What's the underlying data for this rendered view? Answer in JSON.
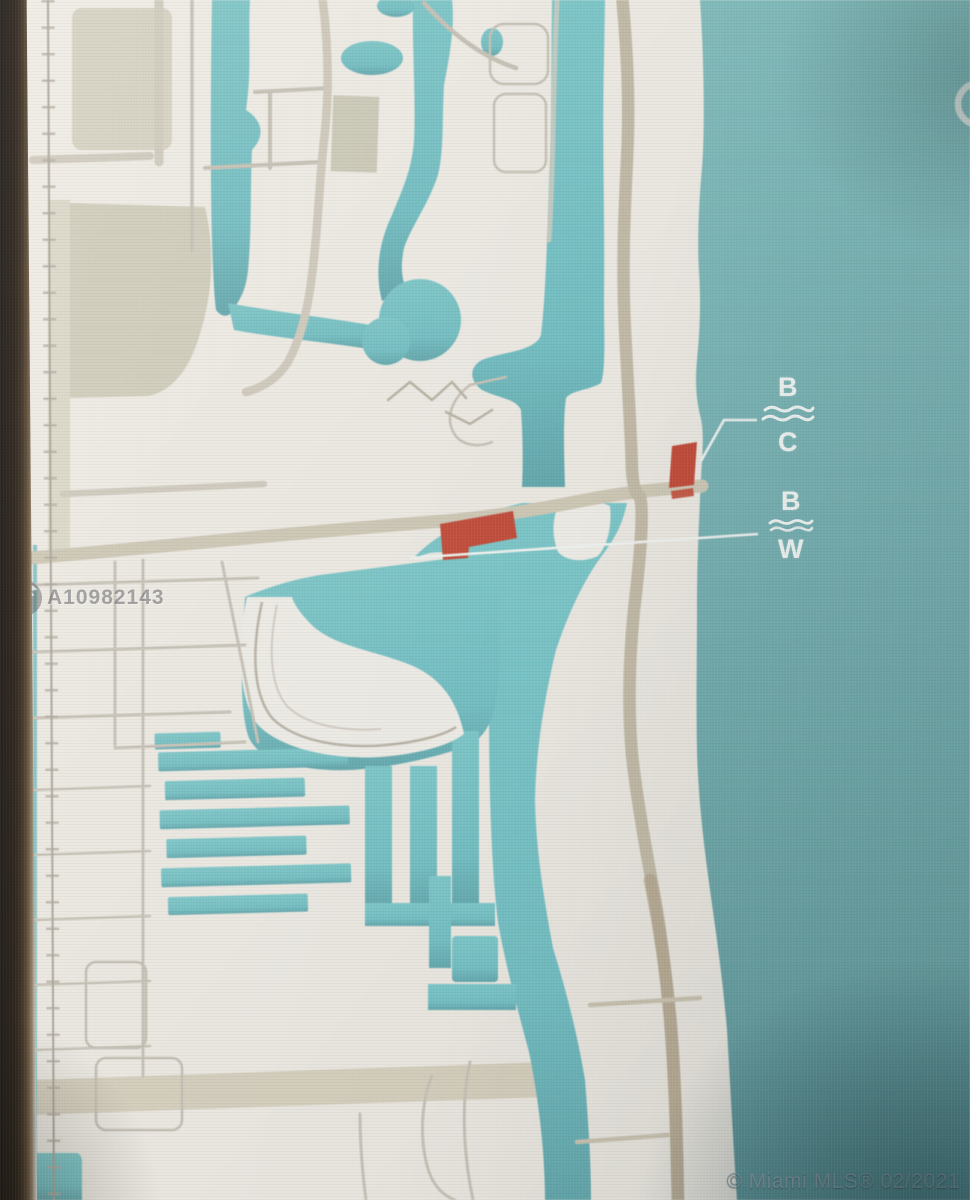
{
  "scene": "photo-of-monitor-showing-mls-location-map",
  "watermark": {
    "icon": "eagle-circle-logo-icon",
    "listing_id": "A10982143"
  },
  "footer": {
    "copyright": "© Miami MLS® 02/2021"
  },
  "annotations": {
    "labels": [
      {
        "id": "label-bc",
        "top": "B",
        "bottom": "C",
        "icon": "double-wave-icon"
      },
      {
        "id": "label-bw",
        "top": "B",
        "bottom": "W",
        "icon": "double-wave-icon"
      }
    ],
    "markers": [
      {
        "id": "marker-island",
        "shape": "red-rectangle-on-barrier-island"
      },
      {
        "id": "marker-mainland",
        "shape": "red-l-shape-on-mainland"
      }
    ],
    "highlight_ring": "partial-white-circle-at-right-edge"
  },
  "map": {
    "features": [
      "ocean",
      "intracoastal-waterway",
      "barrier-island",
      "finger-canals",
      "horseshoe-basin",
      "railroad",
      "main-roads",
      "bridge"
    ]
  },
  "colors": {
    "ocean": "#79b7b9",
    "canal": "#74c3c6",
    "land": "#edeae4",
    "beige": "#d5d1c0",
    "road": "#cbc4b3",
    "marker_red": "#c54a37",
    "annotation_white": "#eef2ef",
    "bezel_dark": "#241a12",
    "watermark_gray": "#45454a",
    "copyright_gray": "#8c9ea8"
  }
}
